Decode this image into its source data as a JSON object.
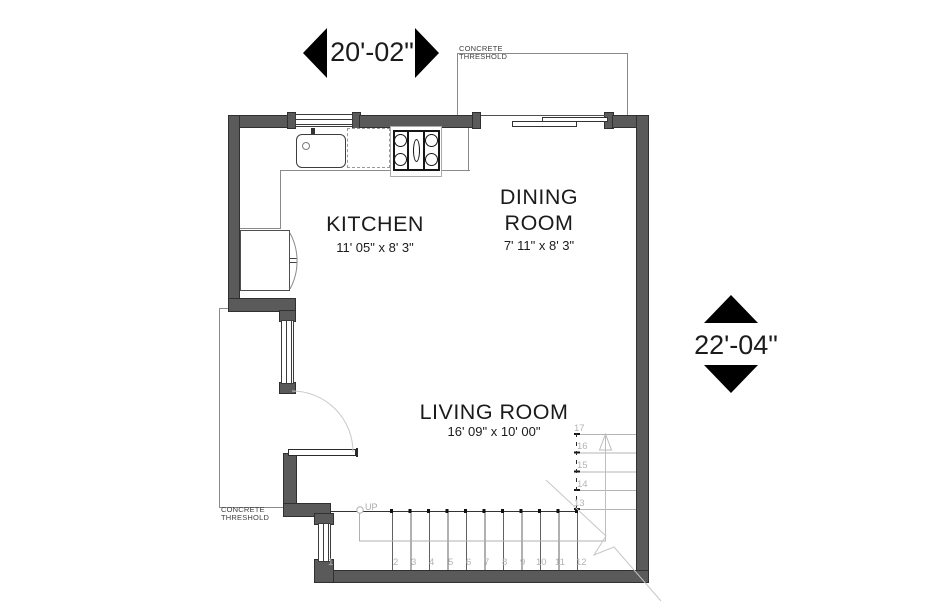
{
  "dimension_labels": {
    "width": "20'-02\"",
    "height": "22'-04\""
  },
  "rooms": {
    "kitchen": {
      "name": "KITCHEN",
      "size": "11' 05\" x 8' 3\""
    },
    "dining_room": {
      "name_line1": "DINING",
      "name_line2": "ROOM",
      "size": "7' 11\" x 8' 3\""
    },
    "living_room": {
      "name": "LIVING ROOM",
      "size": "16' 09\" x 10' 00\""
    }
  },
  "annotations": {
    "threshold": {
      "line1": "CONCRETE",
      "line2": "THRESHOLD"
    },
    "stairs_up": "UP",
    "stair_treads_run": [
      "1",
      "2",
      "3",
      "4",
      "5",
      "6",
      "7",
      "8",
      "9",
      "10",
      "11",
      "12"
    ],
    "stair_treads_winder": [
      "13",
      "14",
      "15",
      "16",
      "17"
    ]
  },
  "colors": {
    "wall_fill": "#5a5a5a",
    "wall_outline": "#303030",
    "light_line": "#9a9a9a",
    "annotation_gray": "#b4b4b4",
    "text": "#1b1b1b"
  }
}
